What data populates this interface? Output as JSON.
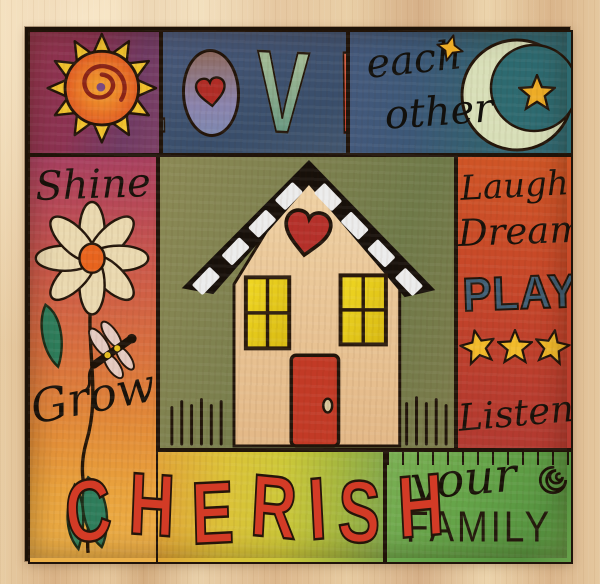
{
  "top": {
    "love_word": "LOVE",
    "love_letters": [
      "L",
      "O",
      "V",
      "E"
    ],
    "each": "each",
    "other": "other"
  },
  "left": {
    "shine": "Shine",
    "grow": "Grow"
  },
  "right": {
    "laugh": "Laugh",
    "dream": "Dream",
    "play": "PLAY",
    "listen": "Listen"
  },
  "bottom": {
    "cherish": "CHERISH",
    "cherish_letters": [
      "C",
      "H",
      "E",
      "R",
      "I",
      "S",
      "H"
    ],
    "your": "your",
    "family": "FAMILY"
  },
  "colors": {
    "wood": "#e2c69e",
    "outline": "#20140a",
    "sun_panel": "#8b3252",
    "love_panel": "#3f5270",
    "sky_panel": "#3c5878",
    "left_panel_top": "#b04560",
    "left_panel_bottom": "#ecb149",
    "house_panel": "#7e814f",
    "right_panel": "#c2422b",
    "cherish_panel": "#cdc839",
    "family_panel": "#63a348",
    "letter_red": "#d33b26",
    "play_blue": "#3f5e74",
    "star_gold": "#f0ba2c",
    "moon_pale": "#d8dfb8",
    "wall_cream": "#ead0a2",
    "window_yellow": "#e8d020",
    "door_red": "#c23a26",
    "heart_red": "#b5302a"
  }
}
